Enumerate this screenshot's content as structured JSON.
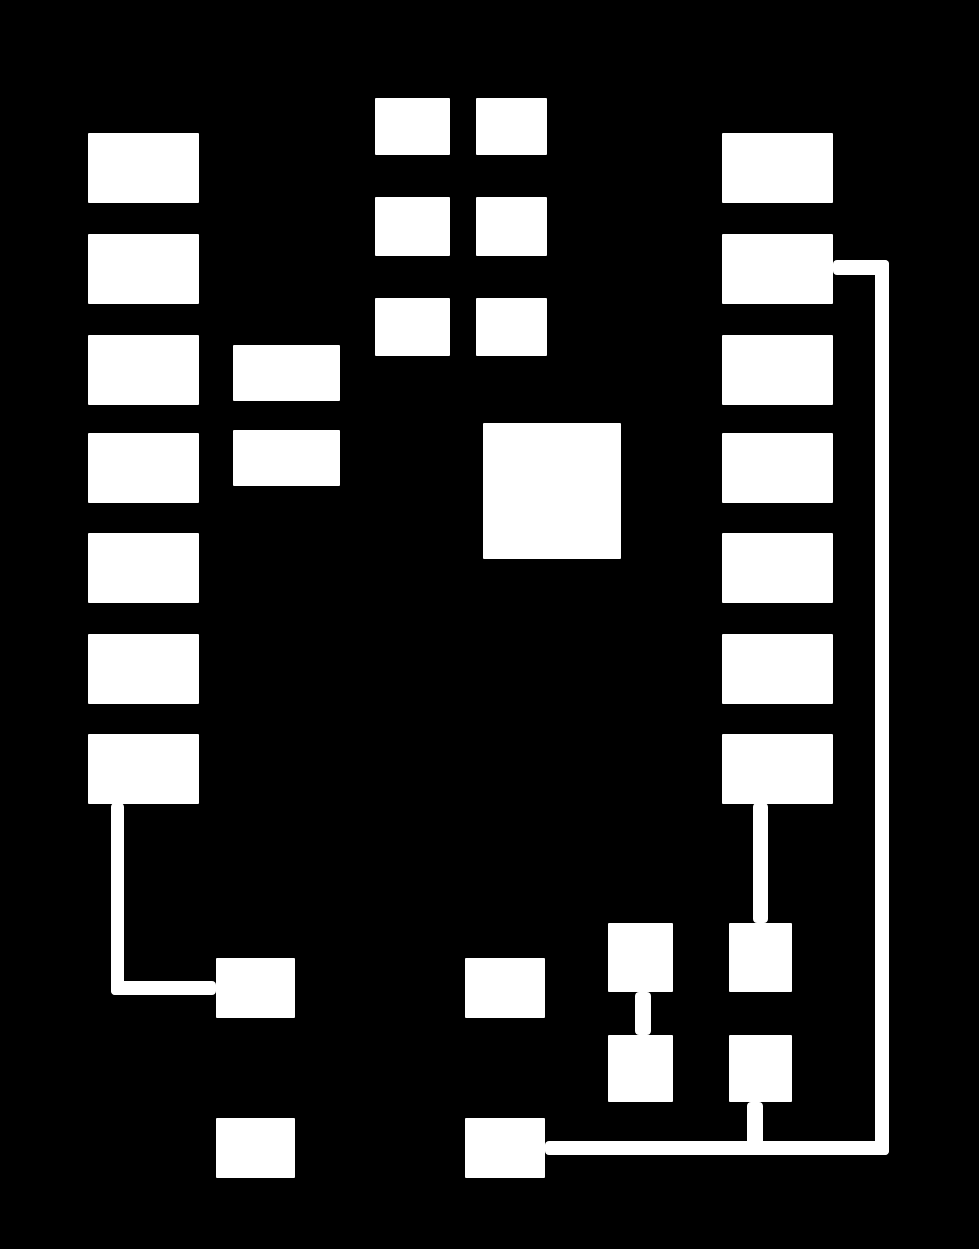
{
  "canvas": {
    "width": 979,
    "height": 1249,
    "background_color": "#000000",
    "shape_color": "#ffffff"
  },
  "nodes": [
    {
      "id": "node-left-col-1",
      "x": 88,
      "y": 133,
      "w": 111,
      "h": 70
    },
    {
      "id": "node-left-col-2",
      "x": 88,
      "y": 234,
      "w": 111,
      "h": 70
    },
    {
      "id": "node-left-col-3",
      "x": 88,
      "y": 335,
      "w": 111,
      "h": 70
    },
    {
      "id": "node-left-col-4",
      "x": 88,
      "y": 433,
      "w": 111,
      "h": 70
    },
    {
      "id": "node-left-col-5",
      "x": 88,
      "y": 533,
      "w": 111,
      "h": 70
    },
    {
      "id": "node-left-col-6",
      "x": 88,
      "y": 634,
      "w": 111,
      "h": 70
    },
    {
      "id": "node-left-col-7",
      "x": 88,
      "y": 734,
      "w": 111,
      "h": 70
    },
    {
      "id": "node-side-col-1",
      "x": 233,
      "y": 345,
      "w": 107,
      "h": 56
    },
    {
      "id": "node-side-col-2",
      "x": 233,
      "y": 430,
      "w": 107,
      "h": 56
    },
    {
      "id": "node-grid-r1c1",
      "x": 375,
      "y": 98,
      "w": 75,
      "h": 57
    },
    {
      "id": "node-grid-r1c2",
      "x": 476,
      "y": 98,
      "w": 71,
      "h": 57
    },
    {
      "id": "node-grid-r2c1",
      "x": 375,
      "y": 197,
      "w": 75,
      "h": 59
    },
    {
      "id": "node-grid-r2c2",
      "x": 476,
      "y": 197,
      "w": 71,
      "h": 59
    },
    {
      "id": "node-grid-r3c1",
      "x": 375,
      "y": 298,
      "w": 75,
      "h": 58
    },
    {
      "id": "node-grid-r3c2",
      "x": 476,
      "y": 298,
      "w": 71,
      "h": 58
    },
    {
      "id": "node-center-large",
      "x": 483,
      "y": 423,
      "w": 138,
      "h": 136
    },
    {
      "id": "node-right-col-1",
      "x": 722,
      "y": 133,
      "w": 111,
      "h": 70
    },
    {
      "id": "node-right-col-2",
      "x": 722,
      "y": 234,
      "w": 111,
      "h": 70
    },
    {
      "id": "node-right-col-3",
      "x": 722,
      "y": 335,
      "w": 111,
      "h": 70
    },
    {
      "id": "node-right-col-4",
      "x": 722,
      "y": 433,
      "w": 111,
      "h": 70
    },
    {
      "id": "node-right-col-5",
      "x": 722,
      "y": 533,
      "w": 111,
      "h": 70
    },
    {
      "id": "node-right-col-6",
      "x": 722,
      "y": 634,
      "w": 111,
      "h": 70
    },
    {
      "id": "node-right-col-7",
      "x": 722,
      "y": 734,
      "w": 111,
      "h": 70
    },
    {
      "id": "node-bottom-left-upper",
      "x": 216,
      "y": 958,
      "w": 79,
      "h": 60
    },
    {
      "id": "node-bottom-mid-upper",
      "x": 465,
      "y": 958,
      "w": 80,
      "h": 60
    },
    {
      "id": "node-cluster-a",
      "x": 608,
      "y": 923,
      "w": 65,
      "h": 69
    },
    {
      "id": "node-cluster-b",
      "x": 729,
      "y": 923,
      "w": 63,
      "h": 69
    },
    {
      "id": "node-cluster-c",
      "x": 608,
      "y": 1035,
      "w": 65,
      "h": 67
    },
    {
      "id": "node-cluster-d",
      "x": 729,
      "y": 1035,
      "w": 63,
      "h": 67
    },
    {
      "id": "node-bottom-left-lower",
      "x": 216,
      "y": 1118,
      "w": 79,
      "h": 60
    },
    {
      "id": "node-bottom-mid-lower",
      "x": 465,
      "y": 1118,
      "w": 80,
      "h": 60
    }
  ],
  "connectors": [
    {
      "id": "connector-left-hook",
      "description": "from bottom of left-col-7 down then right into bottom-left-upper box",
      "segments": [
        {
          "x": 111,
          "y": 803,
          "w": 13,
          "h": 192
        },
        {
          "x": 111,
          "y": 981,
          "w": 105,
          "h": 14
        }
      ]
    },
    {
      "id": "connector-right-loop",
      "description": "from right of right-col-2 across, down the right margin, then left into bottom-mid-lower box",
      "segments": [
        {
          "x": 833,
          "y": 260,
          "w": 56,
          "h": 15
        },
        {
          "x": 875,
          "y": 260,
          "w": 14,
          "h": 895
        },
        {
          "x": 545,
          "y": 1141,
          "w": 344,
          "h": 14
        }
      ]
    },
    {
      "id": "connector-rightcol7-to-b",
      "description": "vertical stub from bottom of right-col-7 to top of cluster-b",
      "segments": [
        {
          "x": 753,
          "y": 803,
          "w": 15,
          "h": 120
        }
      ]
    },
    {
      "id": "connector-a-to-c",
      "description": "vertical stub between cluster-a and cluster-c",
      "segments": [
        {
          "x": 635,
          "y": 992,
          "w": 16,
          "h": 43
        }
      ]
    },
    {
      "id": "connector-d-to-loop",
      "description": "vertical stub from bottom of cluster-d to the loop's bottom rail",
      "segments": [
        {
          "x": 747,
          "y": 1102,
          "w": 16,
          "h": 45
        }
      ]
    }
  ]
}
